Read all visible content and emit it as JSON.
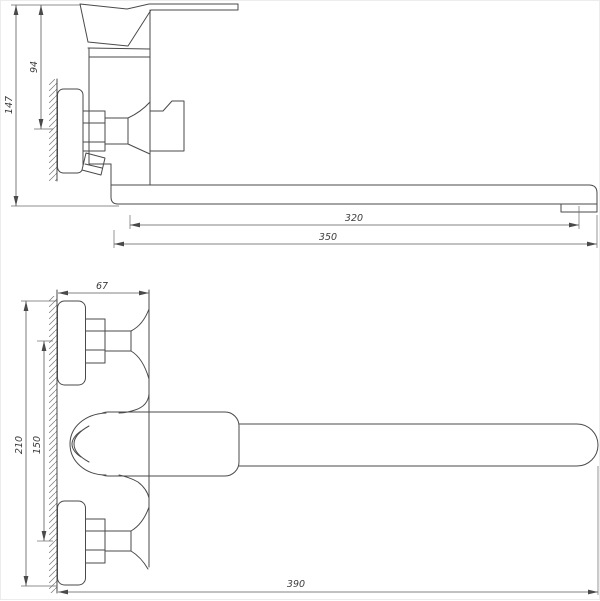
{
  "drawing": {
    "type": "technical-dimension-drawing",
    "subject": "wall-mounted single-lever bath mixer with long swivel spout",
    "units": "mm",
    "colors": {
      "line": "#4a4a4a",
      "dimension_line": "#5a5a5a",
      "text": "#3c3c3c",
      "background": "#ffffff"
    }
  },
  "dimensions": {
    "side_view": {
      "overall_height": "147",
      "handle_height": "94",
      "aerator_reach": "320",
      "spout_reach": "350"
    },
    "top_view": {
      "wall_offset": "67",
      "body_span": "210",
      "inlet_spacing": "150",
      "total_reach": "390"
    }
  }
}
